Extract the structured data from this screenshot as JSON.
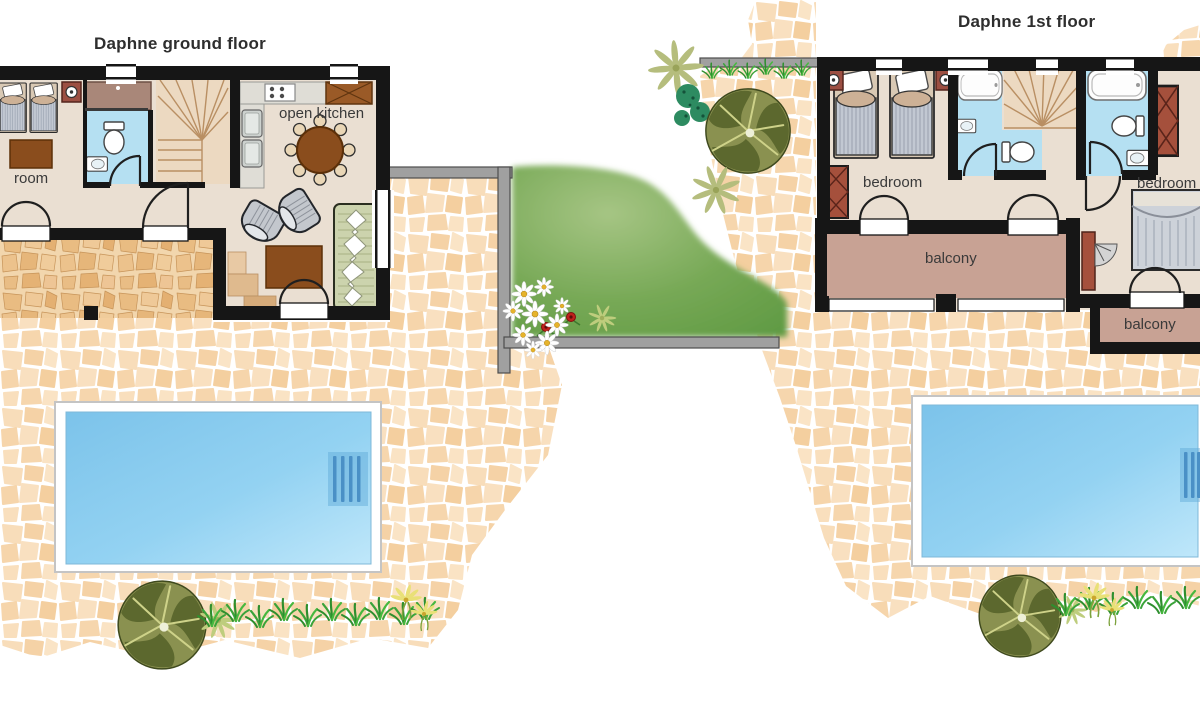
{
  "ground_floor": {
    "title": "Daphne ground floor",
    "room_labels": {
      "room": "room",
      "open_kitchen": "open kitchen"
    }
  },
  "first_floor": {
    "title": "Daphne 1st floor",
    "room_labels": {
      "bedroom_left": "bedroom",
      "bedroom_right": "bedroom",
      "balcony_main": "balcony",
      "balcony_small": "balcony"
    }
  },
  "colors": {
    "wall_black": "#161616",
    "interior_floor": "#eadfd2",
    "bathroom_blue": "#b5e0f2",
    "stairs_beige": "#ecd9c1",
    "pool_water": "#8bcdf0",
    "pool_deck": "#ffffff",
    "stone_light": "#f8ddba",
    "stone_inner": "#eec28c",
    "balcony_floor": "#c8a294",
    "garden_green": "#6ea453",
    "garden_wall_gray": "#a0a0a0",
    "tree_olive": "#6e7a3c",
    "teal_bush": "#2d8b61",
    "grass_green": "#3fae3e",
    "furniture_brown": "#8a4d1d",
    "wardrobe_red": "#a5503c",
    "sofa_green": "#ccd3ad",
    "label_text": "#3a3a3a"
  }
}
